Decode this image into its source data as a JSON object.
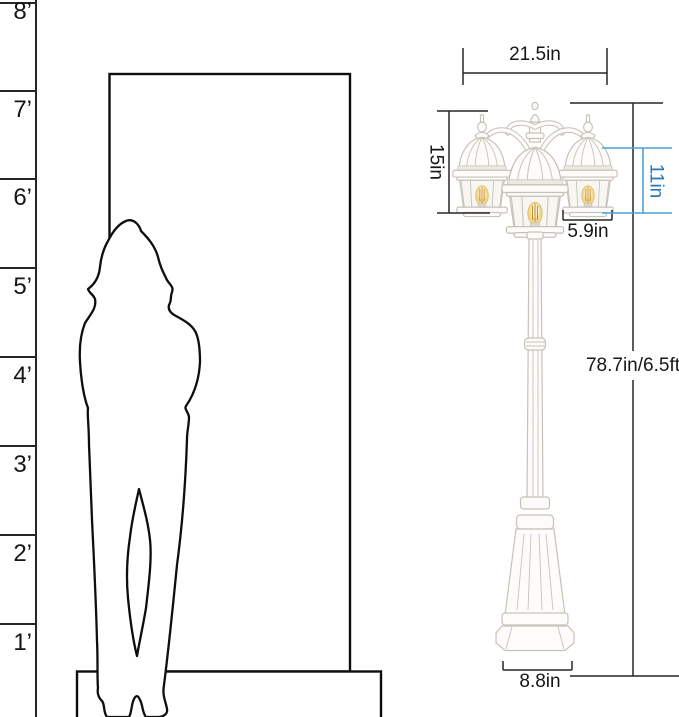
{
  "title": "Outdoor 3-head lamp post size diagram with human figure for scale",
  "colors": {
    "ink": "#1c1c1c",
    "dim-blue-line": "#4aa3d6",
    "dim-blue-text": "#2878b5",
    "lamp-outline": "#c7c2b8",
    "lamp-fill": "#fdfcfa",
    "lamp-shade": "#edeae3",
    "bulb-glow": "#f3d98e",
    "bulb-core": "#fdf3d3",
    "bulb-filament": "#c08a2e"
  },
  "ruler": {
    "unit": "feet",
    "marks": [
      {
        "label": "8’"
      },
      {
        "label": "7’"
      },
      {
        "label": "6’"
      },
      {
        "label": "5’"
      },
      {
        "label": "4’"
      },
      {
        "label": "3’"
      },
      {
        "label": "2’"
      },
      {
        "label": "1’"
      }
    ]
  },
  "dimensions": {
    "top_width": {
      "label": "21.5in"
    },
    "head_height": {
      "label": "15in"
    },
    "lantern_height": {
      "label": "11in"
    },
    "lantern_width": {
      "label": "5.9in"
    },
    "total_height": {
      "label": "78.7in/6.5ft"
    },
    "base_width": {
      "label": "8.8in"
    }
  }
}
